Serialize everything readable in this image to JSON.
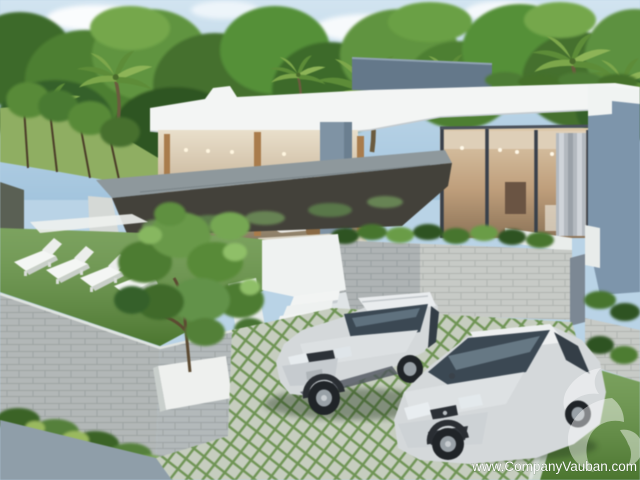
{
  "image": {
    "type": "real-estate-3d-rendering",
    "description": "Modern single-storey white villa with glass walls, open lounge terrace, raised lawn with sun loungers, garden tree in planter, white stairs and two silver cars parked on a grass-paver driveway, tropical palm trees behind"
  },
  "watermark": {
    "url": "www.CompanyVauban.com",
    "logo": "vauban-swirl-logo",
    "text_color": "#fdfdfd"
  },
  "palette": {
    "sky": "#b9d3e6",
    "foliage_dark": "#3e6b2b",
    "foliage_mid": "#5d9140",
    "foliage_light": "#7fae55",
    "house_white": "#f3f5f4",
    "roof_gray": "#64788a",
    "accent_wall_blue": "#7d95ab",
    "wood": "#a97c4c",
    "glass_interior": "#c2a988",
    "stone_wall": "#c7cac6",
    "lawn": "#5f8e3c",
    "pavement": "#a3b1bb",
    "paver_green": "#6f9454",
    "paver_stone": "#c6cdbf",
    "car_silver": "#d4d8da",
    "window_tint": "#3b4853"
  }
}
